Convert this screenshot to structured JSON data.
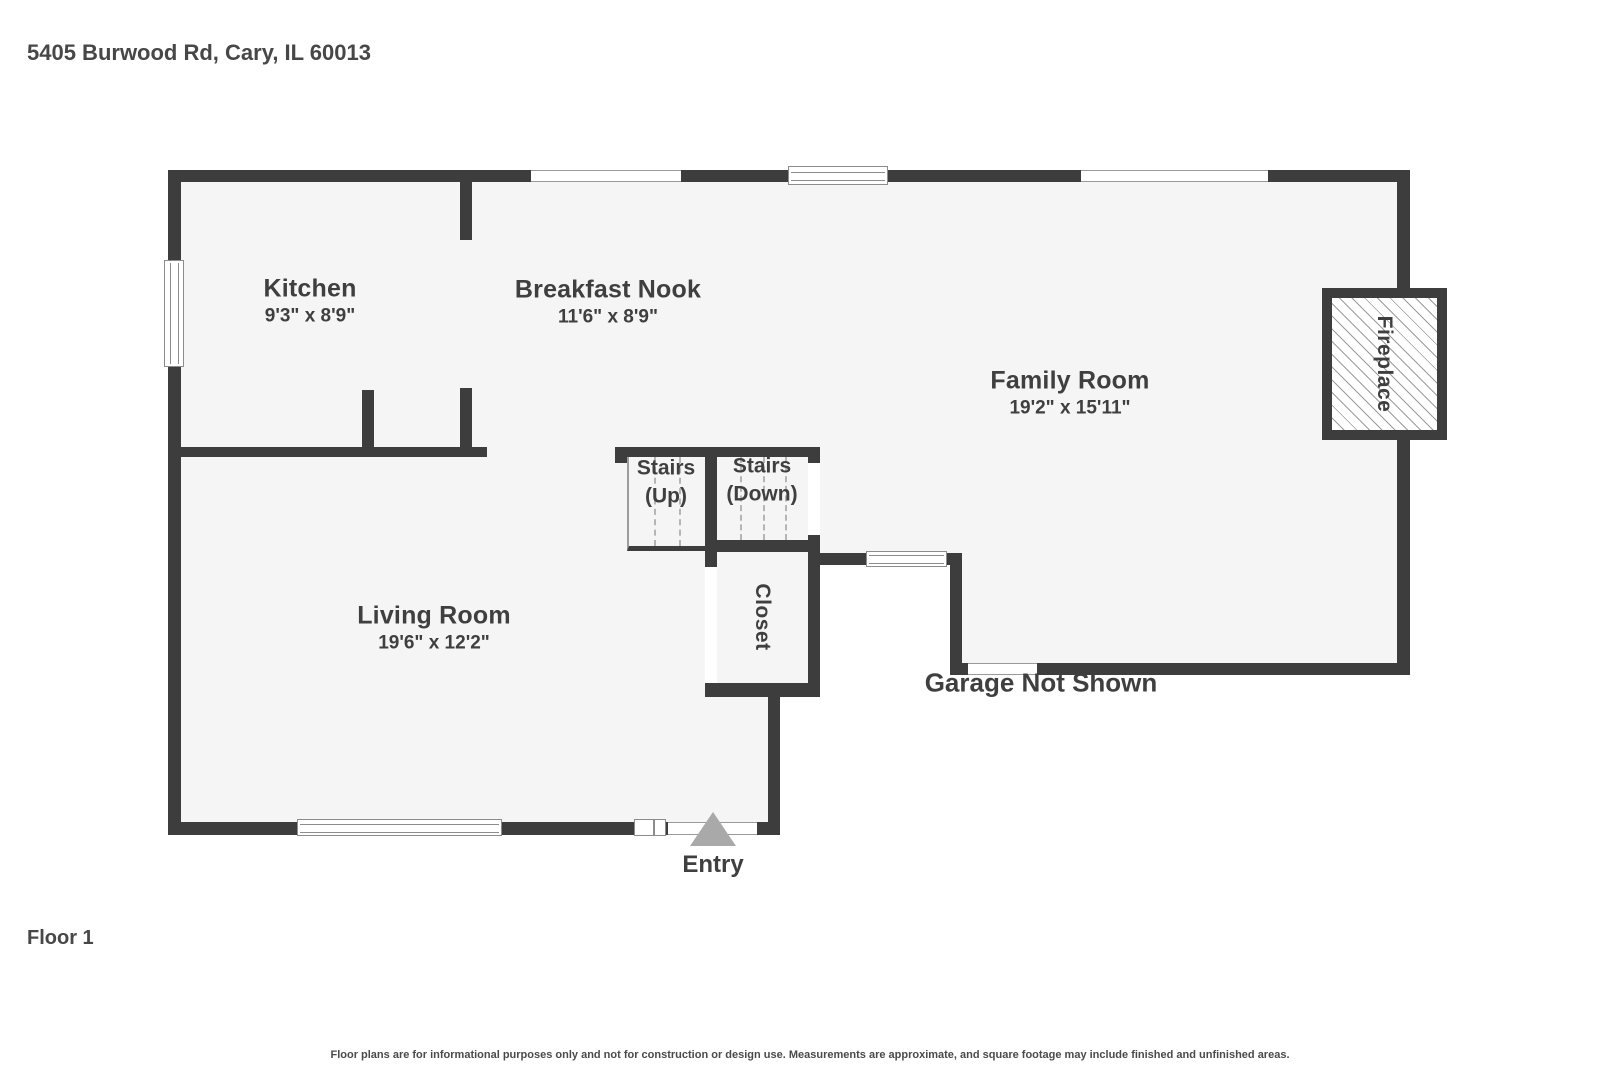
{
  "title": "5405 Burwood Rd, Cary, IL 60013",
  "floor_label": "Floor 1",
  "disclaimer": "Floor plans are for informational purposes only and not for construction or design use. Measurements are approximate, and square footage may include finished and unfinished areas.",
  "entry_label": "Entry",
  "garage_label": "Garage Not Shown",
  "rooms": [
    {
      "name": "Kitchen",
      "dims": "9'3\" x 8'9\""
    },
    {
      "name": "Breakfast Nook",
      "dims": "11'6\" x 8'9\""
    },
    {
      "name": "Family Room",
      "dims": "19'2\" x 15'11\""
    },
    {
      "name": "Living Room",
      "dims": "19'6\" x 12'2\""
    }
  ],
  "features": {
    "stairs_up": {
      "line1": "Stairs",
      "line2": "(Up)"
    },
    "stairs_down": {
      "line1": "Stairs",
      "line2": "(Down)"
    },
    "closet_label": "Closet",
    "fireplace_label": "Fireplace"
  },
  "colors": {
    "wall": "#3d3d3d",
    "floor": "#f5f5f5",
    "text": "#3f3f3f",
    "entry_arrow": "#a9a9a9"
  }
}
